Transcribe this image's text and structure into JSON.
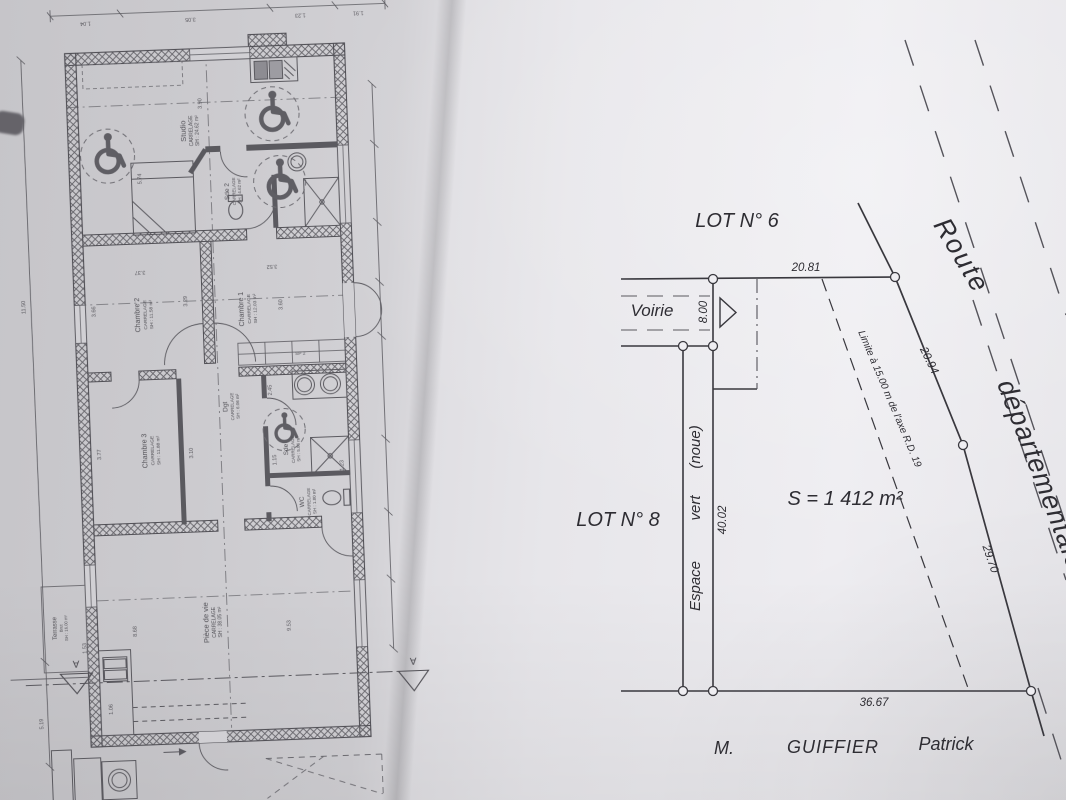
{
  "colors": {
    "paper_left": "#cecdd1",
    "paper_right": "#eae9ed",
    "ink_floor_plan": "#4b4a50",
    "ink_site_plan": "#39383e"
  },
  "floor_plan": {
    "rooms": [
      {
        "name": "Studio",
        "finish": "CARRELAGE",
        "area": "SH : 24.62 m²"
      },
      {
        "name": "Sde 2",
        "finish": "CARRELAGE",
        "area": "SH : 4.62 m²"
      },
      {
        "name": "Chambre 1",
        "finish": "CARRELAGE",
        "area": "SH : 12.03 m²"
      },
      {
        "name": "Chambre 2",
        "finish": "CARRELAGE",
        "area": "SH : 11.58 m²"
      },
      {
        "name": "Chambre 3",
        "finish": "CARRELAGE",
        "area": "SH : 11.88 m²"
      },
      {
        "name": "Dgt",
        "finish": "CARRELAGE",
        "area": "SH : 6.06 m²"
      },
      {
        "name": "Sde",
        "finish": "CARRELAGE",
        "area": "SH : 5.86 m²"
      },
      {
        "name": "WC",
        "finish": "CARRELAGE",
        "area": "SH : 1.80 m²"
      },
      {
        "name": "Pièce de vie",
        "finish": "CARRELAGE",
        "area": "SH : 38.05 m²"
      },
      {
        "name": "Terrasse",
        "finish": "Brut",
        "area": "SH : 16.00 m²"
      }
    ],
    "dims": {
      "left_total": "11.50",
      "left_lower": "5.19",
      "studio_w": "5.74",
      "studio_d": "3.90",
      "ch2_w": "3.66",
      "ch2_d": "3.29",
      "ch2_top": "3.37",
      "ch1_top": "3.52",
      "ch1_d": "3.60",
      "ch3_w": "3.77",
      "ch3_d": "3.10",
      "placard_label": "SP 2",
      "placard_d": "2.45",
      "sde_w": "1.15",
      "wc_w": "1.23",
      "vie_w": "9.53",
      "vie_d": "8.68",
      "kit_a": "1.53",
      "kit_b": "1.06"
    },
    "top_chain": [
      "1.04",
      "3.05",
      "1.23",
      "1.91"
    ],
    "section_marker": "A"
  },
  "site_plan": {
    "lot_top": "LOT N° 6",
    "lot_left": "LOT N° 8",
    "voirie": "Voirie",
    "espace_vert": {
      "w1": "Espace",
      "w2": "vert",
      "w3": "(noue)"
    },
    "area": "S = 1 412 m²",
    "setback": "Limite à 15.00 m de l'axe R.D. 19",
    "road": {
      "l1": "Route",
      "l2": "départementale"
    },
    "dims": {
      "front": "20.81",
      "voirie_width": "8.00",
      "side": "40.02",
      "rear": "36.67",
      "road_a": "20.94",
      "road_b": "29.70"
    },
    "owner": {
      "title": "M.",
      "last_name": "GUIFFIER",
      "first_name": "Patrick"
    }
  }
}
